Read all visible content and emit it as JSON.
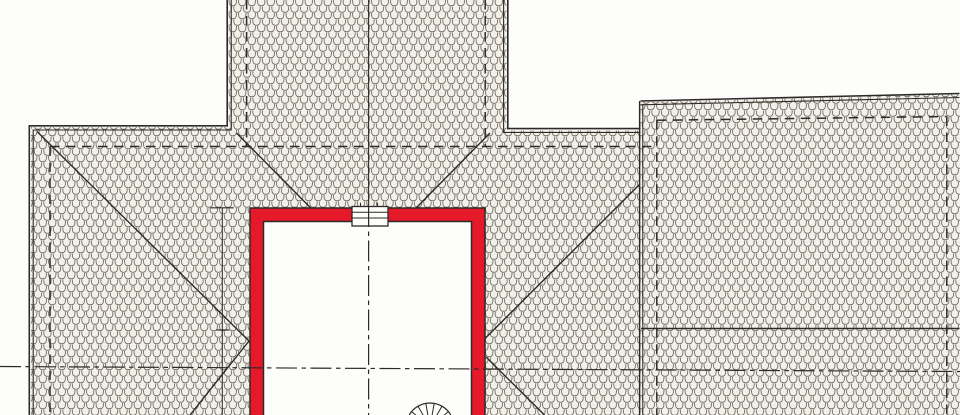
{
  "drawing": {
    "kind": "architectural-roof-plan",
    "label": ""
  },
  "colors": {
    "paper": "#fdfdfc",
    "hatch_bg": "#f3f0ea",
    "hatch_stroke": "#6b655e",
    "line": "#2c2a28",
    "accent_red": "#e6192b"
  },
  "elements": {
    "roof_hatch": "roof-tile-hatching",
    "eave_edges": "double-line-roof-eaves",
    "wall_lines": "dashed-wall-outlines-below-roof",
    "hip_valley": "hip-and-valley-lines",
    "ridge": "ridge-lines",
    "courtyard": "red-highlighted-courtyard-shaft",
    "chimney": "chimney-symbol",
    "spiral_stair": "spiral-staircase-symbol",
    "center_axes": "dash-dot-center-axes",
    "dimension_line": "vertical-reference-line-with-ticks"
  }
}
